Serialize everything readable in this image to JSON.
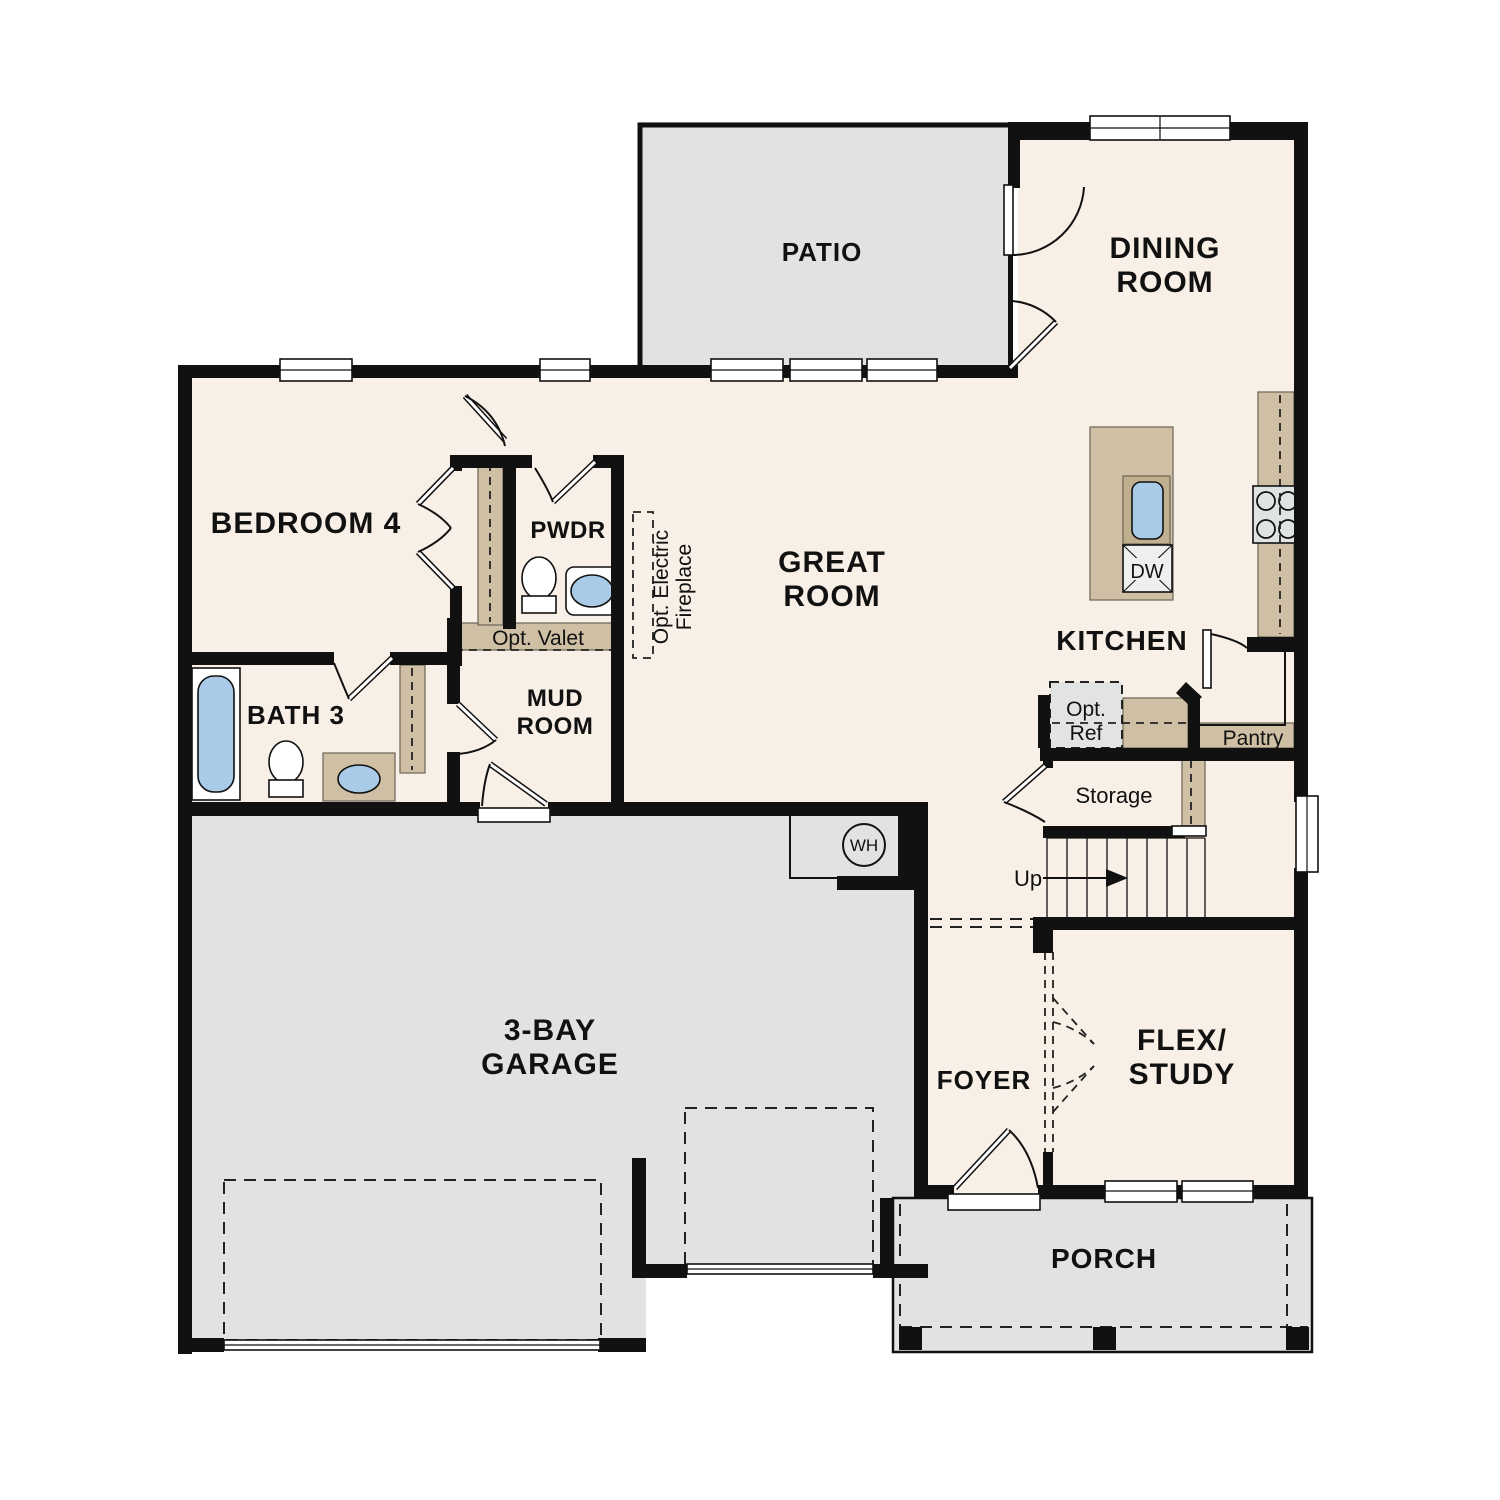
{
  "plan_title": "Single-story floor plan",
  "colors": {
    "wall": "#111111",
    "interior_floor": "#f8efe6",
    "exterior_floor": "#e4e2e0",
    "cabinetry_tan": "#cfc0a5",
    "water_fixture_blue": "#a9cbe8",
    "appliance_gray": "#e0e3e4",
    "background": "#ffffff"
  },
  "rooms": {
    "patio": {
      "label": "PATIO"
    },
    "dining_room": {
      "label_line1": "DINING",
      "label_line2": "ROOM"
    },
    "bedroom_4": {
      "label": "BEDROOM 4"
    },
    "pwdr": {
      "label": "PWDR"
    },
    "great_room": {
      "label_line1": "GREAT",
      "label_line2": "ROOM"
    },
    "kitchen": {
      "label": "KITCHEN"
    },
    "bath_3": {
      "label": "BATH 3"
    },
    "mud_room": {
      "label_line1": "MUD",
      "label_line2": "ROOM"
    },
    "garage": {
      "label_line1": "3-BAY",
      "label_line2": "GARAGE"
    },
    "foyer": {
      "label": "FOYER"
    },
    "flex_study": {
      "label_line1": "FLEX/",
      "label_line2": "STUDY"
    },
    "porch": {
      "label": "PORCH"
    }
  },
  "annotations": {
    "opt_valet": "Opt. Valet",
    "opt_electric_fireplace_line1": "Opt. Electric",
    "opt_electric_fireplace_line2": "Fireplace",
    "opt_ref_line1": "Opt.",
    "opt_ref_line2": "Ref",
    "pantry": "Pantry",
    "storage": "Storage",
    "stairs_direction": "Up",
    "dishwasher": "DW",
    "water_heater": "WH"
  }
}
